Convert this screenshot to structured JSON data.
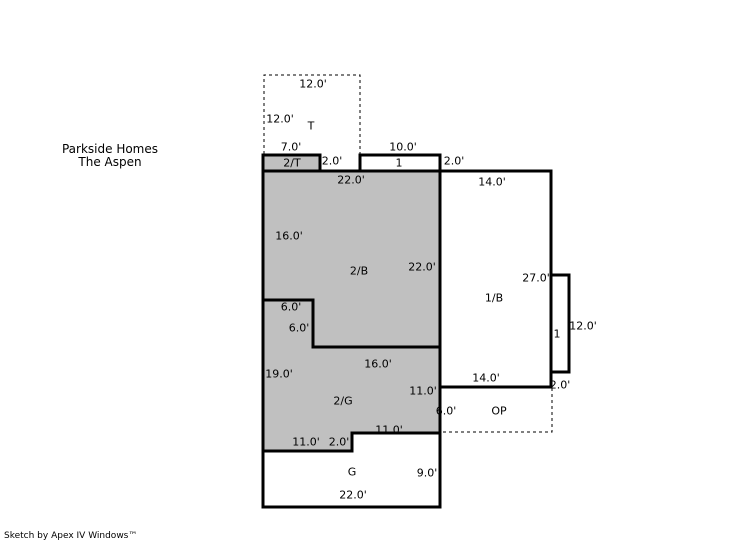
{
  "header": {
    "project": "Parkside Homes",
    "model": "The Aspen"
  },
  "footer": {
    "credit": "Sketch by Apex IV Windows™"
  },
  "colors": {
    "shaded": "#c0c0c0",
    "line": "#000000",
    "background": "#ffffff"
  },
  "floorplan": {
    "terrace": {
      "label": "T",
      "width_label": "12.0'",
      "depth_label": "12.0'"
    },
    "terrace_2t": {
      "label": "2/T",
      "width_label": "7.0'",
      "depth_label": "2.0'"
    },
    "stoop": {
      "label": "1",
      "width_label": "10.0'",
      "depth_label": "2.0'"
    },
    "area_2b": {
      "label": "2/B",
      "top_label": "22.0'",
      "left_label": "16.0'",
      "right_label": "22.0'",
      "notch_width_label": "6.0'",
      "notch_height_label": "6.0'"
    },
    "area_1b": {
      "label": "1/B",
      "top_label": "14.0'",
      "right_label": "27.0'",
      "bottom_label": "14.0'",
      "bottom_right_label": "2.0'"
    },
    "bay": {
      "label": "1",
      "height_label": "12.0'"
    },
    "area_2g": {
      "label": "2/G",
      "left_label": "19.0'",
      "top_label": "16.0'",
      "right_label": "11.0'",
      "bottom_right_label": "11.0'",
      "bottom_left_label": "11.0'",
      "step_label": "2.0'"
    },
    "porch": {
      "label": "OP",
      "left_label": "6.0'"
    },
    "garage": {
      "label": "G",
      "right_label": "9.0'",
      "bottom_label": "22.0'"
    }
  }
}
